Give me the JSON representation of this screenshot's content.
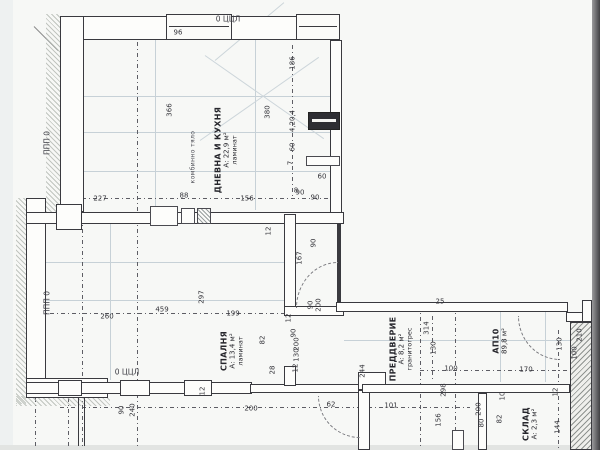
{
  "colors": {
    "paper": "#f7f8f6",
    "line": "#3a3a3f",
    "faint": "#c7d1d7",
    "hatch": "#b3b8b2",
    "edge_dark": "#404043"
  },
  "plan": {
    "rooms": [
      {
        "name": "ДНЕВНА И КУХНЯ",
        "area": "А: 22,9 м²",
        "floor": "ламинат"
      },
      {
        "name": "СПАЛНЯ",
        "area": "А: 13,4 м²",
        "floor": "ламинат"
      },
      {
        "name": "ПРЕДДВЕРИЕ",
        "area": "А: 8,2 м²",
        "floor": "гранитогрес"
      },
      {
        "name": "АП10",
        "area": "89,8 м²"
      },
      {
        "name": "СКЛАД",
        "area": "А: 2,3 м²"
      }
    ],
    "axis_labels": [
      {
        "t": "ППП 0",
        "x": 47,
        "y": 143,
        "r": "v"
      },
      {
        "t": "ППП 0",
        "x": 47,
        "y": 303,
        "r": "v"
      },
      {
        "t": "0 ЦЦЛ",
        "x": 228,
        "y": 19,
        "r": "h"
      },
      {
        "t": "0 ЦЦЛ",
        "x": 127,
        "y": 372,
        "r": "h"
      }
    ],
    "notes": [
      {
        "t": "комбинно тяло",
        "x": 193,
        "y": 157,
        "r": "v"
      }
    ],
    "dimensions": [
      {
        "t": "96",
        "x": 178,
        "y": 33,
        "r": "h"
      },
      {
        "t": "366",
        "x": 170,
        "y": 110,
        "r": "v"
      },
      {
        "t": "380",
        "x": 268,
        "y": 112,
        "r": "v"
      },
      {
        "t": "186",
        "x": 293,
        "y": 63,
        "r": "v"
      },
      {
        "t": "4,20,4",
        "x": 293,
        "y": 121,
        "r": "v"
      },
      {
        "t": "60",
        "x": 293,
        "y": 147,
        "r": "v"
      },
      {
        "t": "7",
        "x": 291,
        "y": 163,
        "r": "v"
      },
      {
        "t": "60",
        "x": 322,
        "y": 177,
        "r": "h"
      },
      {
        "t": "90",
        "x": 300,
        "y": 193,
        "r": "h"
      },
      {
        "t": "227",
        "x": 100,
        "y": 199,
        "r": "h"
      },
      {
        "t": "88",
        "x": 184,
        "y": 196,
        "r": "h"
      },
      {
        "t": "156",
        "x": 247,
        "y": 199,
        "r": "h"
      },
      {
        "t": "8",
        "x": 296,
        "y": 191,
        "r": "h"
      },
      {
        "t": "90",
        "x": 315,
        "y": 198,
        "r": "h"
      },
      {
        "t": "12",
        "x": 269,
        "y": 231,
        "r": "v"
      },
      {
        "t": "90",
        "x": 314,
        "y": 243,
        "r": "v"
      },
      {
        "t": "167",
        "x": 300,
        "y": 258,
        "r": "v"
      },
      {
        "t": "90",
        "x": 311,
        "y": 305,
        "r": "v"
      },
      {
        "t": "200",
        "x": 319,
        "y": 305,
        "r": "v"
      },
      {
        "t": "12",
        "x": 289,
        "y": 318,
        "r": "v"
      },
      {
        "t": "90",
        "x": 294,
        "y": 333,
        "r": "v"
      },
      {
        "t": "200",
        "x": 297,
        "y": 344,
        "r": "v"
      },
      {
        "t": "130",
        "x": 297,
        "y": 355,
        "r": "v"
      },
      {
        "t": "82",
        "x": 263,
        "y": 340,
        "r": "v"
      },
      {
        "t": "28",
        "x": 273,
        "y": 370,
        "r": "v"
      },
      {
        "t": "12",
        "x": 296,
        "y": 368,
        "r": "v"
      },
      {
        "t": "297",
        "x": 202,
        "y": 297,
        "r": "v"
      },
      {
        "t": "260",
        "x": 107,
        "y": 317,
        "r": "h"
      },
      {
        "t": "459",
        "x": 162,
        "y": 310,
        "r": "h"
      },
      {
        "t": "199",
        "x": 233,
        "y": 314,
        "r": "h"
      },
      {
        "t": "90",
        "x": 122,
        "y": 410,
        "r": "v"
      },
      {
        "t": "240",
        "x": 133,
        "y": 410,
        "r": "v"
      },
      {
        "t": "12",
        "x": 203,
        "y": 391,
        "r": "v"
      },
      {
        "t": "200",
        "x": 251,
        "y": 409,
        "r": "h"
      },
      {
        "t": "62",
        "x": 331,
        "y": 405,
        "r": "h"
      },
      {
        "t": "101",
        "x": 391,
        "y": 406,
        "r": "h"
      },
      {
        "t": "244",
        "x": 363,
        "y": 371,
        "r": "v"
      },
      {
        "t": "25",
        "x": 440,
        "y": 302,
        "r": "h"
      },
      {
        "t": "314",
        "x": 427,
        "y": 328,
        "r": "v"
      },
      {
        "t": "130",
        "x": 434,
        "y": 348,
        "r": "v"
      },
      {
        "t": "100",
        "x": 451,
        "y": 369,
        "r": "h"
      },
      {
        "t": "298",
        "x": 444,
        "y": 390,
        "r": "v"
      },
      {
        "t": "170",
        "x": 526,
        "y": 370,
        "r": "h"
      },
      {
        "t": "130",
        "x": 560,
        "y": 344,
        "r": "v"
      },
      {
        "t": "210",
        "x": 580,
        "y": 335,
        "r": "v"
      },
      {
        "t": "100",
        "x": 575,
        "y": 353,
        "r": "v"
      },
      {
        "t": "12",
        "x": 556,
        "y": 392,
        "r": "v"
      },
      {
        "t": "144",
        "x": 558,
        "y": 427,
        "r": "v"
      },
      {
        "t": "200",
        "x": 479,
        "y": 409,
        "r": "v"
      },
      {
        "t": "80",
        "x": 482,
        "y": 423,
        "r": "v"
      },
      {
        "t": "82",
        "x": 500,
        "y": 419,
        "r": "v"
      },
      {
        "t": "10",
        "x": 503,
        "y": 396,
        "r": "v"
      },
      {
        "t": "156",
        "x": 439,
        "y": 420,
        "r": "v"
      }
    ]
  }
}
